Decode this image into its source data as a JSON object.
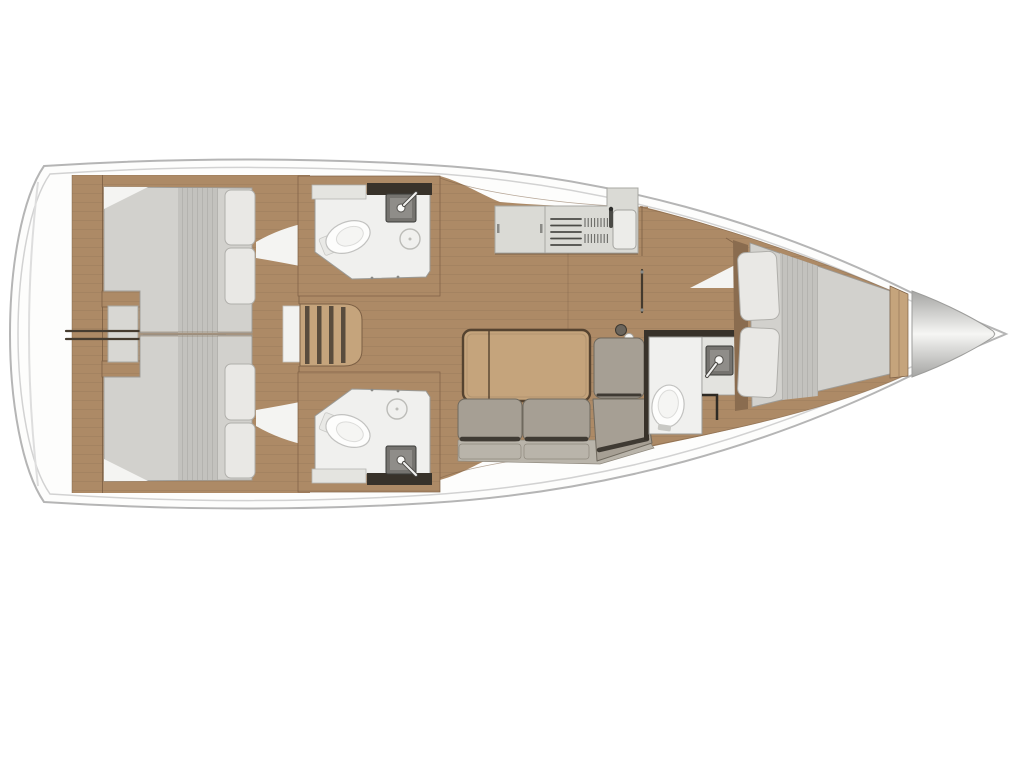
{
  "document": {
    "kind": "sailboat-interior-deck-plan",
    "orientation": "bow-right",
    "visible_text": ""
  },
  "colors": {
    "hull-line": "#b5b5b5",
    "hull-inner-line": "#d2d2d2",
    "wood": "#ad8a66",
    "wood-light": "#c5a47c",
    "wood-dark": "#7c5f44",
    "dark-wall": "#38322a",
    "mattress": "#d2d1cd",
    "mattress-quilt": "#c3c2be",
    "pillow": "#e9e8e5",
    "pillow-edge": "#b0afab",
    "sofa": "#a69f94",
    "sofa-base": "#b9b4aa",
    "sofa-shadow": "#3f3a33",
    "bath-floor": "#f0f0ee",
    "bath-wall": "#9a9a96",
    "fixture-white": "#fdfdfc",
    "fixture-line": "#c2c2c0",
    "sink-dark": "#75736f",
    "sink-inner": "#8f8d89",
    "counter": "#dadad5",
    "counter-line": "#a8a8a3",
    "metal-dark": "#4a4a46",
    "engine-gray": "#d8d7d3",
    "bow-silver-mid": "#f6f6f4",
    "bow-silver-edge": "#a5a5a3"
  },
  "legend": {
    "rooms": [
      {
        "id": "aft-cabin-port",
        "features": [
          "double-berth",
          "two-pillows"
        ]
      },
      {
        "id": "aft-cabin-starboard",
        "features": [
          "double-berth",
          "two-pillows"
        ]
      },
      {
        "id": "engine-compartment",
        "features": [
          "access-hatch"
        ]
      },
      {
        "id": "head-port",
        "features": [
          "toilet",
          "sink",
          "shower-drain"
        ]
      },
      {
        "id": "head-starboard",
        "features": [
          "toilet",
          "sink",
          "shower-drain"
        ]
      },
      {
        "id": "companionway",
        "features": [
          "steps",
          "landing"
        ]
      },
      {
        "id": "galley",
        "features": [
          "counter",
          "stove",
          "drain-rack",
          "sink",
          "faucet"
        ]
      },
      {
        "id": "saloon",
        "features": [
          "folding-table",
          "l-shaped-sofa",
          "mast-post"
        ]
      },
      {
        "id": "forward-head",
        "features": [
          "toilet",
          "sink",
          "faucet"
        ]
      },
      {
        "id": "forward-cabin",
        "features": [
          "v-berth",
          "two-pillows"
        ]
      },
      {
        "id": "bow",
        "features": [
          "anchor-locker"
        ]
      }
    ]
  }
}
